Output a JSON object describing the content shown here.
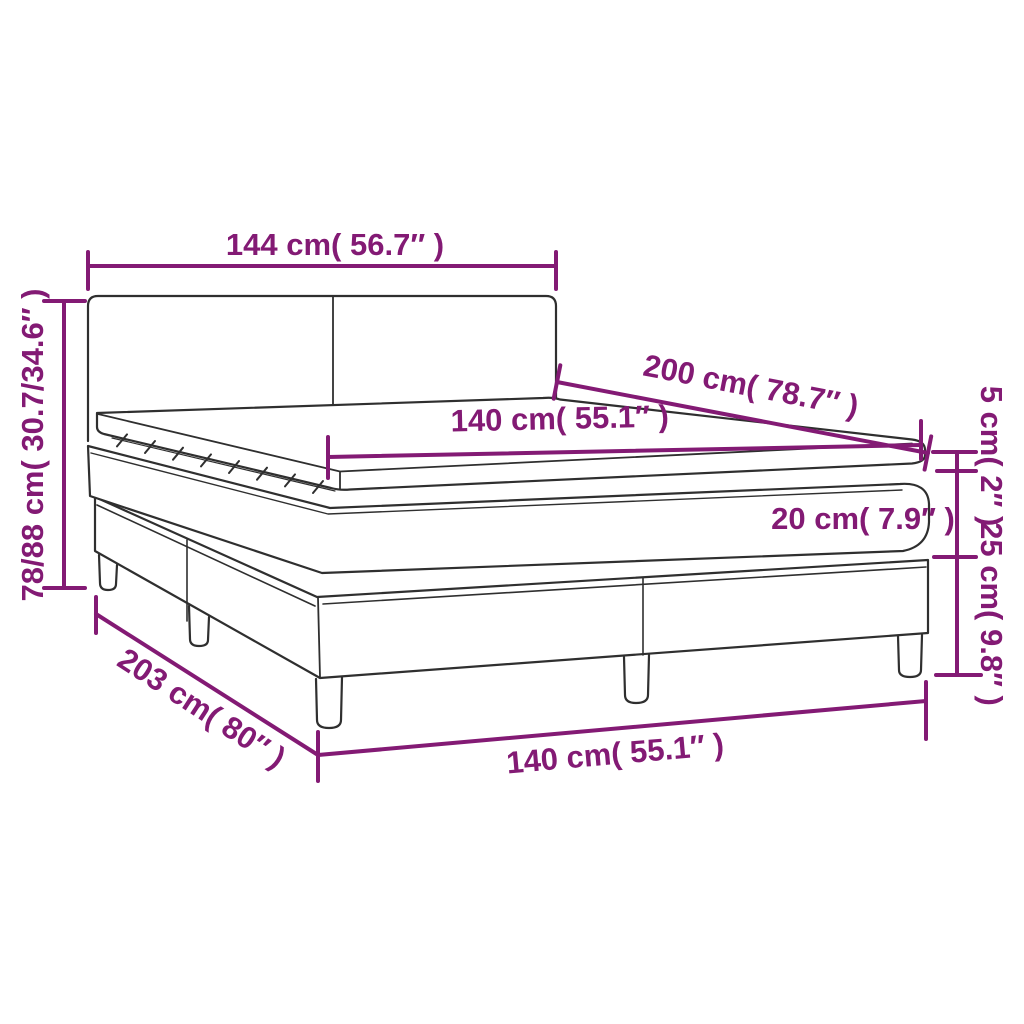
{
  "diagram": {
    "type": "product-dimension-diagram",
    "colors": {
      "dimension_accent": "#831a74",
      "outline": "#2f2f2f",
      "background": "#ffffff"
    },
    "labels": {
      "headboard_width": "144 cm( 56.7″ )",
      "overall_height": "78/88 cm( 30.7/34.6″ )",
      "mattress_length": "200 cm( 78.7″ )",
      "mattress_width": "140 cm( 55.1″ )",
      "topper_height": "5 cm( 2″ )",
      "mattress_height": "20 cm( 7.9″ )",
      "base_height": "25 cm( 9.8″ )",
      "frame_length": "203 cm( 80″ )",
      "frame_width": "140 cm( 55.1″ )"
    }
  }
}
